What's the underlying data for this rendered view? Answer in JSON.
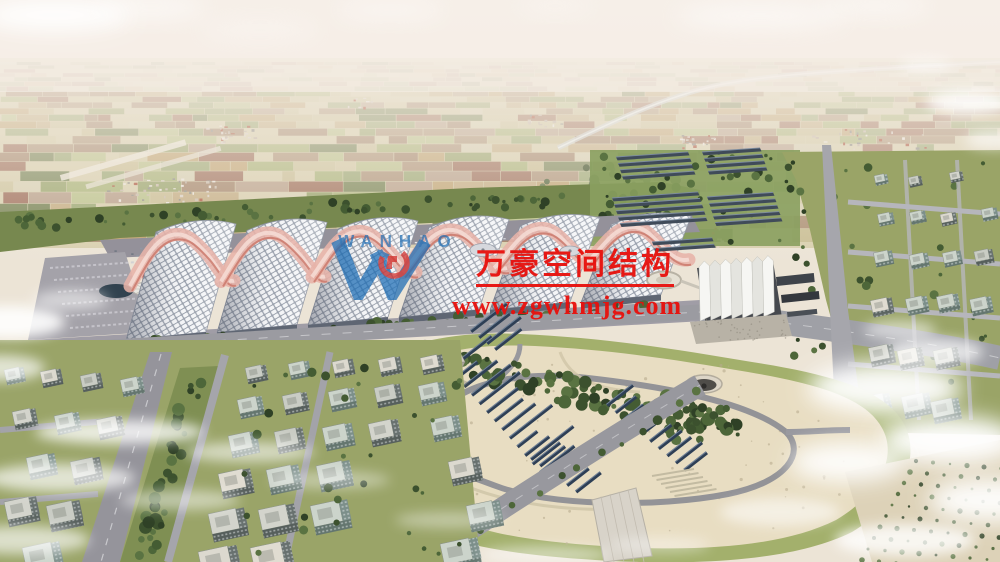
{
  "watermark": {
    "company_name": "万豪空间结构",
    "website": "www.zgwhmjg.com",
    "logo_letters": "WANHAO",
    "text_color": "#e8100c",
    "logo_color": "#1b6cb4"
  }
}
